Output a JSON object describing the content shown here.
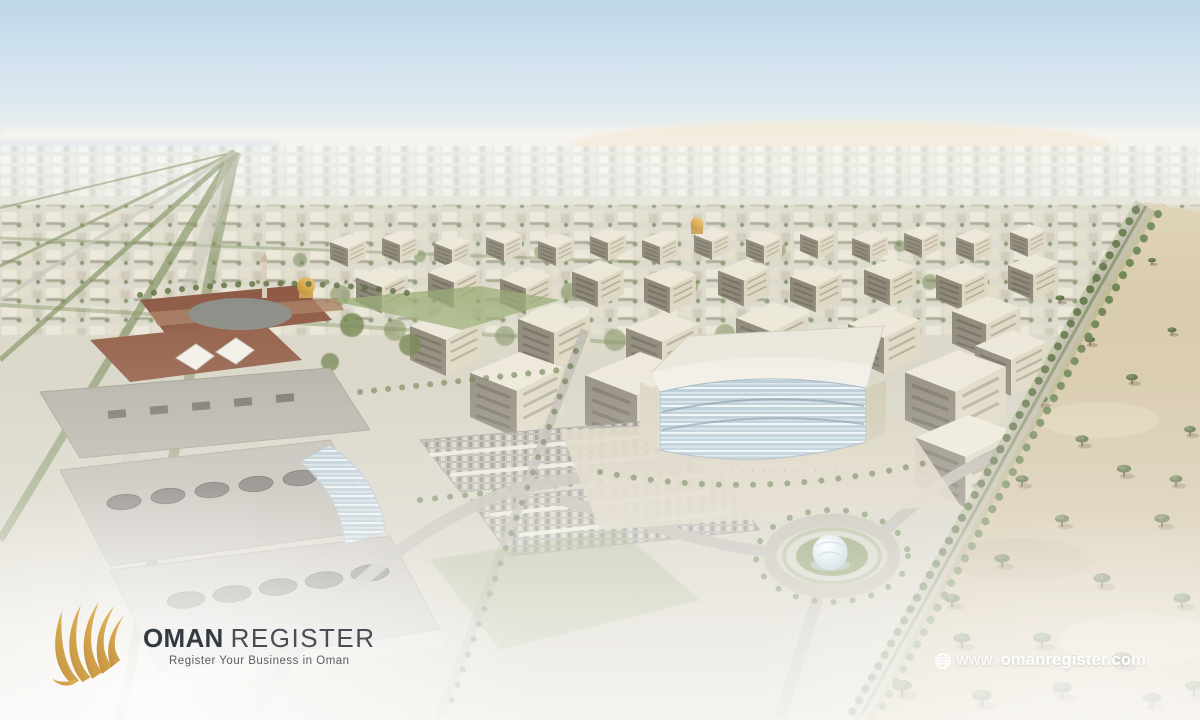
{
  "branding": {
    "logo": {
      "primary": "OMAN",
      "secondary": "REGISTER",
      "tagline": "Register Your Business in Oman"
    },
    "website": {
      "prefix": "www.",
      "domain": "omanregister.com"
    },
    "colors": {
      "gold": "#D2A04C",
      "logo_dark": "#343A41",
      "logo_gray": "#474E56",
      "tagline_gray": "#575D64",
      "url_white": "#FFFFFF"
    }
  },
  "scene": {
    "alt": "Aerial daytime render of a master-planned business city: rows of beige office buildings along tree-lined boulevards, a brick campus with a golden mosque dome and minaret, large institutional buildings with oval skylights, shaded parking lots, a roundabout with a glass dome fountain, and desert with scattered acacia trees on the right under a hazy blue sky."
  }
}
